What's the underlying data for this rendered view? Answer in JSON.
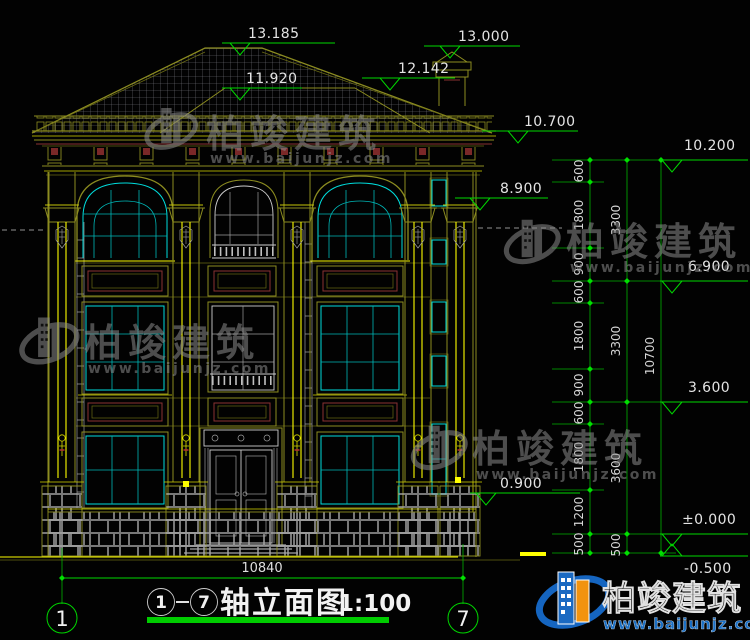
{
  "title": {
    "axis_start": "1",
    "axis_end": "7",
    "name": "轴立面图",
    "scale": "1:100"
  },
  "axis_bubbles": {
    "left": "1",
    "right": "7"
  },
  "levels": {
    "peak": "13.185",
    "chimney": "13.000",
    "ridge_right": "12.142",
    "ridge_left": "11.920",
    "eave": "10.700",
    "parapet": "10.200",
    "floor3_band": "8.900",
    "floor3": "6.900",
    "floor2": "3.600",
    "sill1": "0.900",
    "zero": "±0.000",
    "ground": "-0.500"
  },
  "dims": {
    "inner": [
      "600",
      "1800",
      "900",
      "600",
      "1800",
      "900",
      "600",
      "1800",
      "1200",
      "500"
    ],
    "middle": [
      "3300",
      "3300",
      "3600",
      "500"
    ],
    "outer": [
      "10700"
    ],
    "width": "10840"
  },
  "watermark": {
    "brand": "柏竣建筑",
    "url": "www.baijunjz.com"
  },
  "logo": {
    "brand": "柏竣建筑",
    "url": "www.baijunjz.com"
  },
  "colors": {
    "background": "#020202",
    "cad_olive": "#8c8c20",
    "cad_yellow": "#ffff00",
    "cad_cyan": "#00dcdc",
    "cad_green": "#00d800",
    "cad_white": "#cdcdcd",
    "cad_dark_red": "#8a3232",
    "logo_blue": "#1a6fc4",
    "logo_orange": "#f2930f"
  }
}
